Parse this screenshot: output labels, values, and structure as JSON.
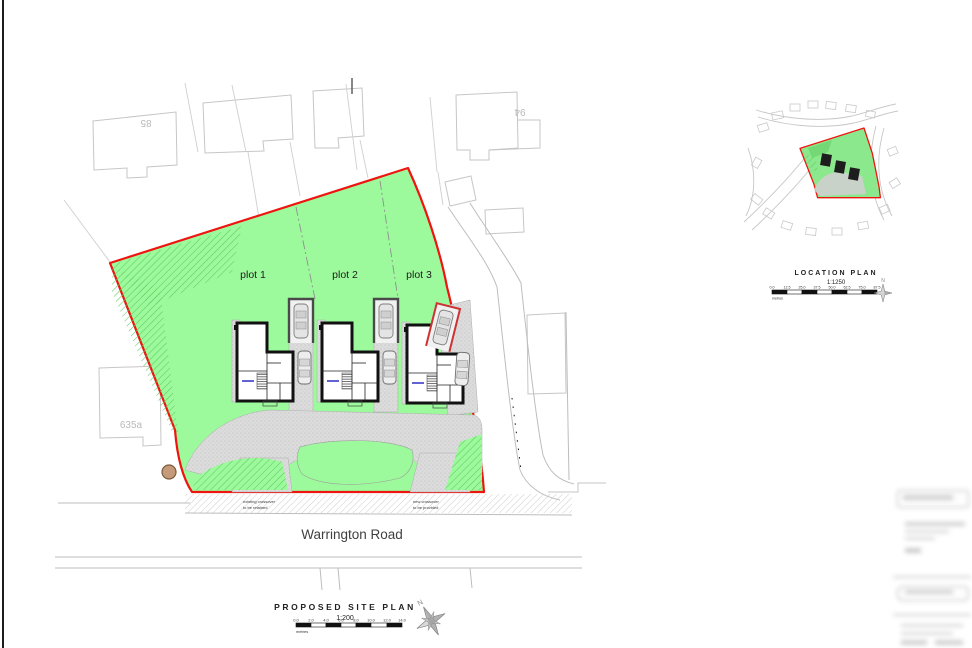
{
  "drawing": {
    "site_plan": {
      "title": "PROPOSED SITE PLAN",
      "scale_label": "1:200",
      "scale_unit": "metres",
      "scale_ticks": [
        "0.0",
        "2.0",
        "4.0",
        "6.0",
        "8.0",
        "10.0",
        "12.0",
        "14.0"
      ],
      "road_label": "Warrington Road",
      "north_label": "N",
      "plot_labels": [
        "plot 1",
        "plot 2",
        "plot 3"
      ],
      "neighbor_house_numbers": [
        "85",
        "94",
        "635a"
      ],
      "annotations": [
        {
          "line1": "existing crossover",
          "line2": "to be retained"
        },
        {
          "line1": "new crossover",
          "line2": "to be provided"
        }
      ]
    },
    "location_plan": {
      "title": "LOCATION PLAN",
      "scale_label": "1:1250",
      "scale_unit": "metres",
      "scale_ticks": [
        "0.0",
        "12.5",
        "25.0",
        "37.5",
        "50.0",
        "62.5",
        "75.0",
        "87.5"
      ],
      "north_label": "N"
    },
    "colors": {
      "site_green": "#9cfa9c",
      "boundary_red": "#ee1511",
      "hatch_green": "#5fc95f",
      "driveway_grey": "#dcdcdc",
      "neighbor_outline_grey": "#c6c6c6",
      "wall_black": "#111111",
      "text_dark": "#2e2e2e",
      "tree_brown": "#c49a7a"
    }
  }
}
